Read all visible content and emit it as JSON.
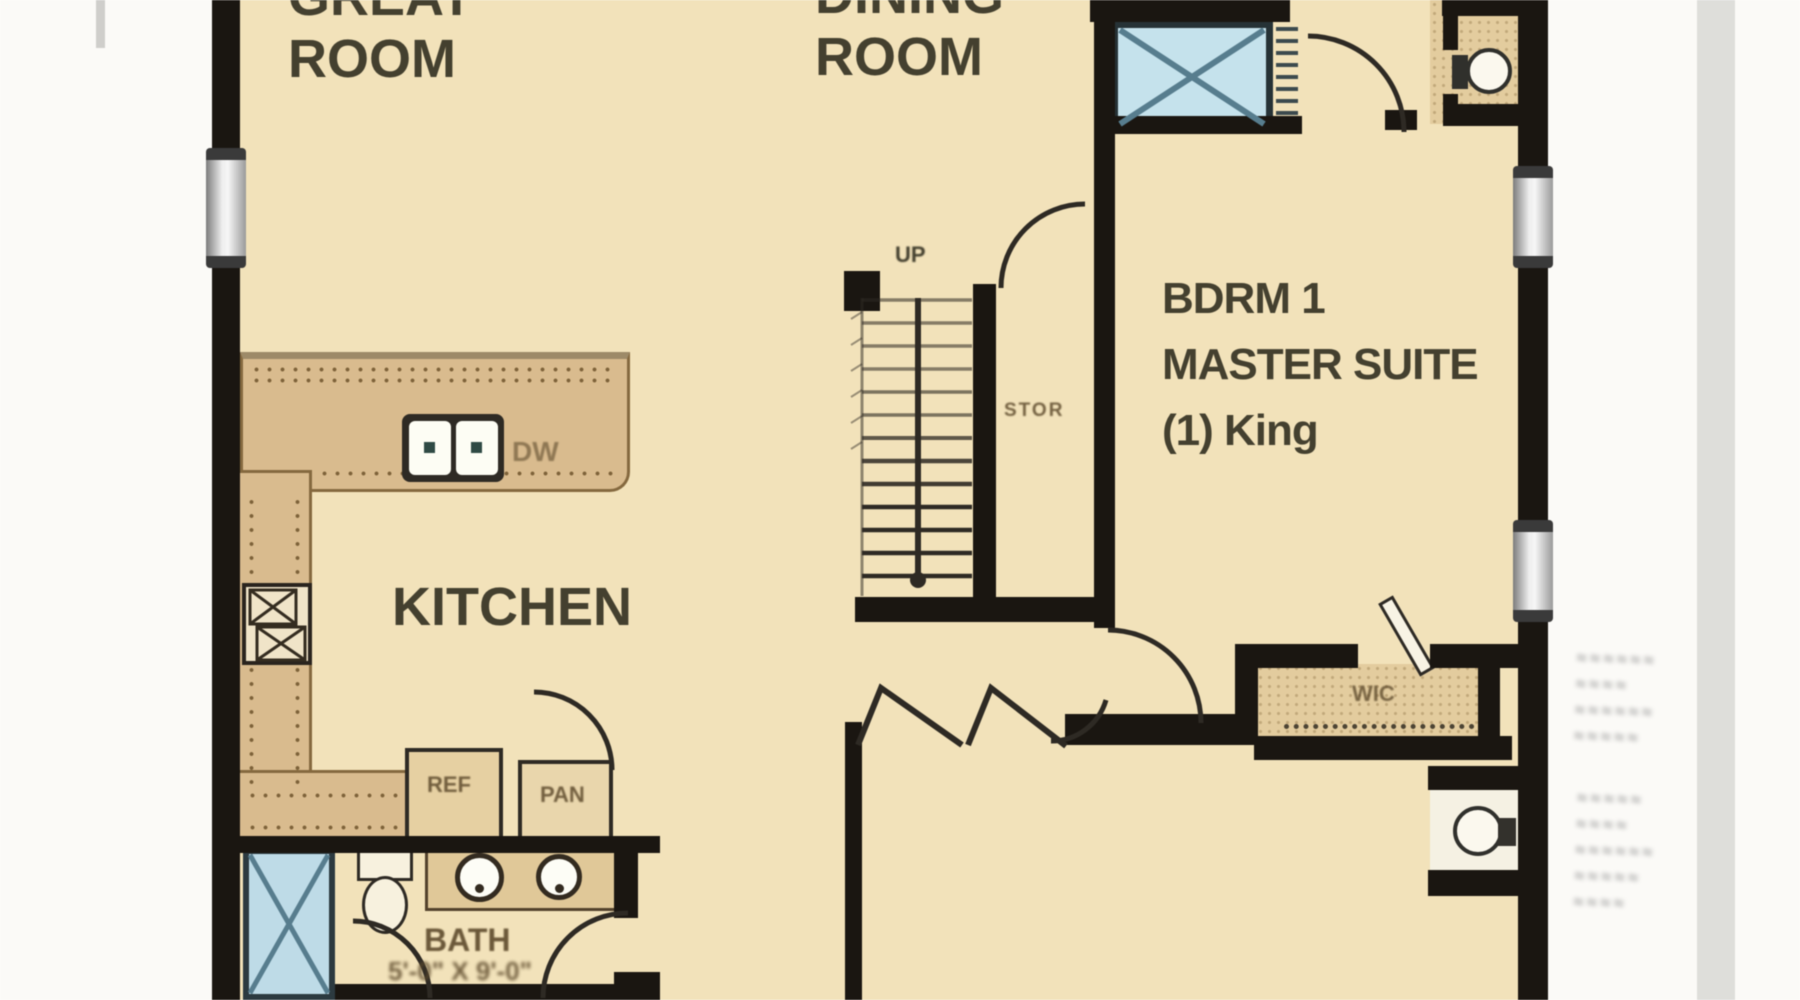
{
  "labels": {
    "great_room": "GREAT ROOM",
    "dining_room": "DINING ROOM",
    "kitchen": "KITCHEN",
    "master_line1": "BDRM 1",
    "master_line2": "MASTER SUITE",
    "master_line3": "(1) King",
    "up": "UP",
    "stor": "STOR",
    "wic": "WIC",
    "ref": "REF",
    "pan": "PAN",
    "dw": "DW",
    "bath": "BATH",
    "bath_dim": "5'-0\" X 9'-0\""
  },
  "margin_notes": {
    "note": "illegible blurred dimension text outside right wall",
    "block1": "≈≈≈≈≈≈\n ≈≈≈≈\n≈≈≈≈≈≈\n≈≈≈≈≈",
    "block2": "≈≈≈≈≈\n ≈≈≈≈\n≈≈≈≈≈≈\n≈≈≈≈≈\n ≈≈≈≈"
  },
  "colors": {
    "outside": "#fbfaf7",
    "floor": "#f2e2ba",
    "wall": "#1a1611",
    "line": "#2e2a24",
    "counter": "#d9bb8e",
    "counteredge": "#85693f",
    "dot": "#7d6239",
    "shaded": "#e3cc9e",
    "showerfill": "#bedbe7",
    "showerline": "#577d8e",
    "strip": "#dededa",
    "text": "#44402f",
    "brown": "#5d4a2c"
  }
}
